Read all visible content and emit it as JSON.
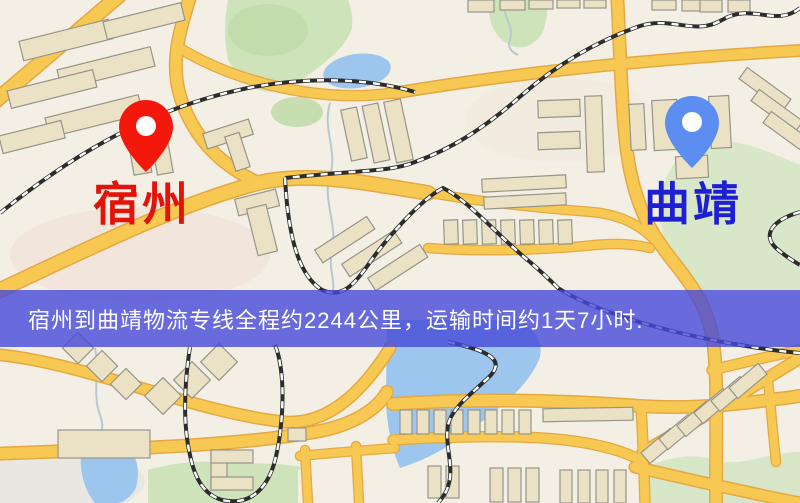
{
  "banner": {
    "text": "宿州到曲靖物流专线全程约2244公里，运输时间约1天7小时.",
    "background_color": "#4648d8",
    "text_color": "#ffffff"
  },
  "markers": {
    "origin": {
      "label": "宿州",
      "pin_color": "#f3170c",
      "label_color": "#e41309"
    },
    "destination": {
      "label": "曲靖",
      "pin_color": "#5c8df0",
      "label_color": "#1e1ed2"
    }
  },
  "map_palette": {
    "background": "#f3efe5",
    "road_fill": "#f7c953",
    "road_casing": "#e5a843",
    "building_fill": "#ebe1c5",
    "park_green": "#cfe3bb",
    "water_blue": "#9cc6ed",
    "railway_black": "#2c2c2c"
  }
}
